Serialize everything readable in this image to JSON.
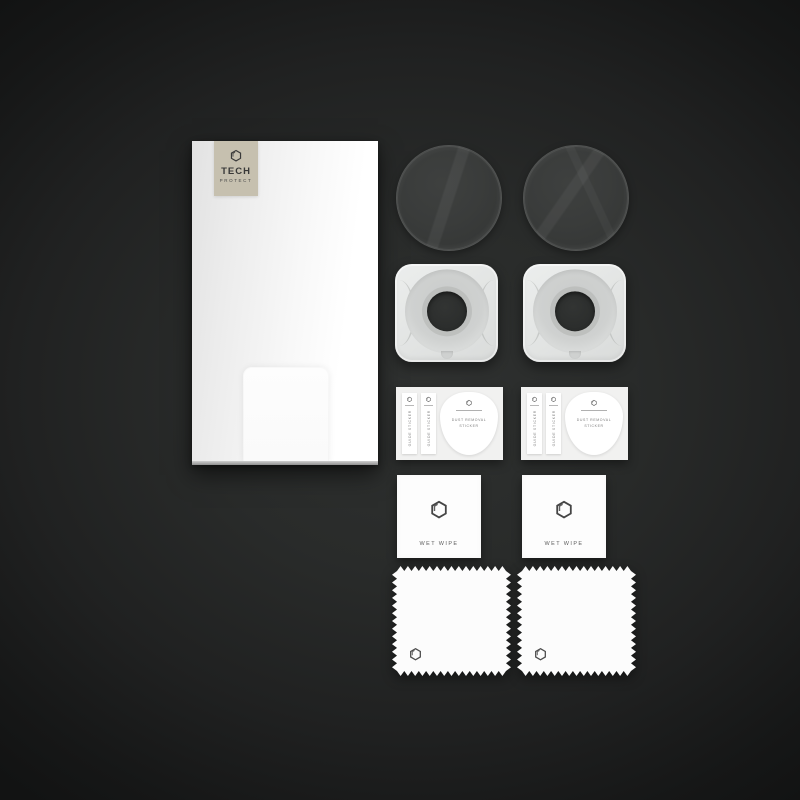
{
  "brand": {
    "name_line1": "TECH",
    "name_line2": "PROTECT",
    "logo_icon": "hexagon-icon",
    "label_bg_color": "#c6c0af"
  },
  "sticker_sheet": {
    "guide_sticker_label": "GUIDE STICKER",
    "dust_removal_label_line1": "DUST REMOVAL",
    "dust_removal_label_line2": "STICKER",
    "icon": "hexagon-icon"
  },
  "wet_wipe": {
    "label": "WET WIPE",
    "icon": "hexagon-icon"
  },
  "cloth": {
    "icon": "hexagon-icon"
  },
  "colors": {
    "background_center": "#2f3130",
    "background_edge": "#121313",
    "item_white": "#fcfcfc",
    "glass_tint": "#3a3c3b"
  }
}
